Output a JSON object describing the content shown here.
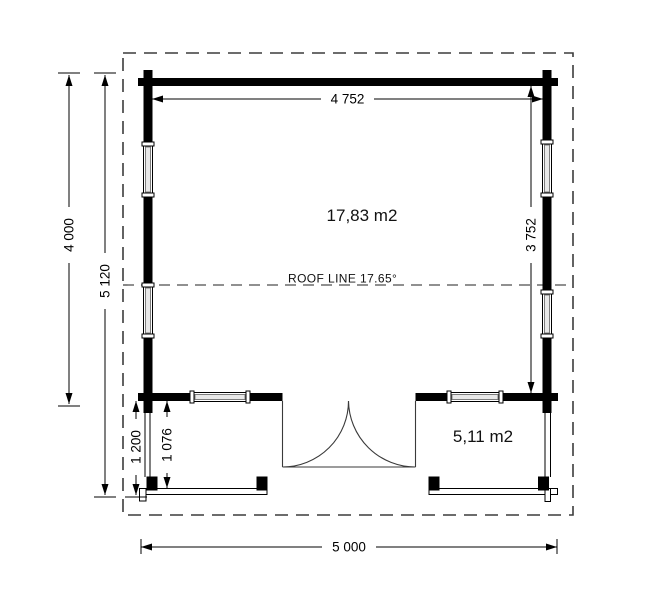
{
  "labels": {
    "main_area": "17,83 m2",
    "porch_area": "5,11 m2",
    "roof_line": "ROOF LINE 17.65°"
  },
  "dimensions": {
    "top_width": "4 752",
    "room_depth": "3 752",
    "house_depth": "4 000",
    "total_depth": "5 120",
    "porch_depth": "1 200",
    "porch_inner_depth": "1 076",
    "overall_width": "5 000"
  },
  "colors": {
    "wall": "#000000",
    "line": "#222222",
    "dashed_outline": "#3c3c3c",
    "background": "#ffffff"
  }
}
